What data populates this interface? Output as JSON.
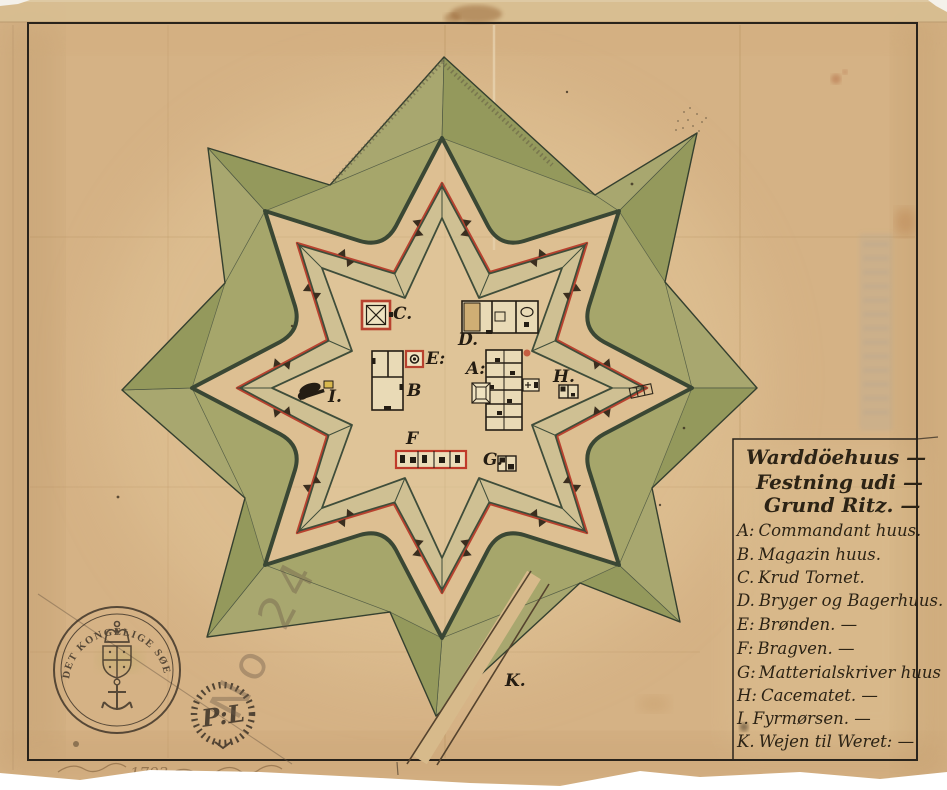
{
  "map": {
    "legend": {
      "title_line1": "Warddöehuus —",
      "title_line2": "Festning udi —",
      "title_line3": "Grund Ritz. —",
      "items": [
        {
          "key": "A:",
          "label": "Commandant huus."
        },
        {
          "key": "B.",
          "label": "Magazin huus."
        },
        {
          "key": "C.",
          "label": "Krud Tornet."
        },
        {
          "key": "D.",
          "label": "Bryger og Bagerhuus."
        },
        {
          "key": "E:",
          "label": "Brønden. —"
        },
        {
          "key": "F:",
          "label": "Bragven. —"
        },
        {
          "key": "G:",
          "label": "Matterialskriver huus"
        },
        {
          "key": "H:",
          "label": "Cacematet. —"
        },
        {
          "key": "I.",
          "label": "Fyrmørsen. —"
        },
        {
          "key": "K.",
          "label": "Wejen til Weret: —"
        }
      ]
    },
    "plan_labels": {
      "a": "A:",
      "b": "B",
      "c": "C.",
      "d": "D.",
      "e": "E:",
      "f": "F",
      "g": "G.",
      "h": "H.",
      "i": "I.",
      "k": "K."
    },
    "stamps": {
      "archive_ring_text": "DET KONGELIGE SØE KAARTE ARCHIV",
      "monogram": "P:L",
      "pencil_number": "No 24",
      "handwritten_year": "1793"
    },
    "colors": {
      "paper": "#d5b285",
      "glacis_green": "#a6a66b",
      "wall_green": "#3f4d3a",
      "rampart_red": "#b8422f",
      "ink": "#2a2118"
    }
  }
}
